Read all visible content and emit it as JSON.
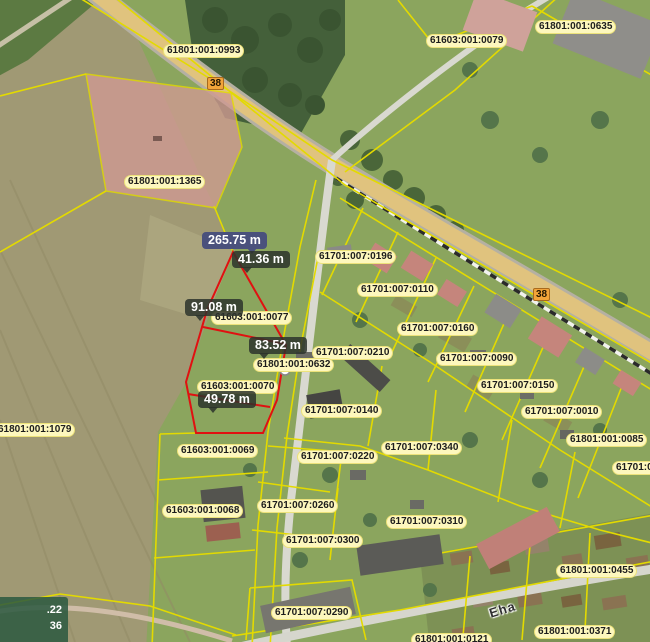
{
  "app": {
    "type": "cadastral-map-viewer"
  },
  "colors": {
    "parcel-line": "#e3da00",
    "measure-line": "#e01111",
    "label-bg": "#fdf7bd",
    "label-border": "#ece27a",
    "label-text": "#1c1c1c",
    "road-badge-bg": "#f2a43a",
    "road-badge-border": "#a86a1e",
    "measure-seg-bg": "rgba(44,51,44,0.85)",
    "measure-total-bg": "#4a517c",
    "measure-text": "#ffffff",
    "coords-bg": "rgba(42,88,64,0.85)",
    "coords-text": "#ffffff"
  },
  "cadastral_labels": [
    {
      "text": "61801:001:0993",
      "x": 163,
      "y": 44
    },
    {
      "text": "61603:001:0079",
      "x": 426,
      "y": 34
    },
    {
      "text": "61801:001:0635",
      "x": 535,
      "y": 20
    },
    {
      "text": "61801:001:1365",
      "x": 124,
      "y": 175
    },
    {
      "text": "61701:007:0196",
      "x": 315,
      "y": 250
    },
    {
      "text": "61701:007:0110",
      "x": 357,
      "y": 283
    },
    {
      "text": "61603:001:0077",
      "x": 211,
      "y": 311
    },
    {
      "text": "61701:007:0160",
      "x": 397,
      "y": 322
    },
    {
      "text": "61701:007:0210",
      "x": 312,
      "y": 346
    },
    {
      "text": "61701:007:0090",
      "x": 436,
      "y": 352
    },
    {
      "text": "61801:001:0632",
      "x": 253,
      "y": 358
    },
    {
      "text": "61701:007:0150",
      "x": 477,
      "y": 379
    },
    {
      "text": "61603:001:0070",
      "x": 197,
      "y": 380
    },
    {
      "text": "61701:007:0140",
      "x": 301,
      "y": 404
    },
    {
      "text": "61701:007:0010",
      "x": 521,
      "y": 405
    },
    {
      "text": "61801:001:1079",
      "x": -6,
      "y": 423
    },
    {
      "text": "61801:001:0085",
      "x": 566,
      "y": 433
    },
    {
      "text": "61701:007:0340",
      "x": 381,
      "y": 441
    },
    {
      "text": "61603:001:0069",
      "x": 177,
      "y": 444
    },
    {
      "text": "61701:007:0220",
      "x": 297,
      "y": 450
    },
    {
      "text": "61701:00",
      "x": 612,
      "y": 461
    },
    {
      "text": "61701:007:0260",
      "x": 257,
      "y": 499
    },
    {
      "text": "61603:001:0068",
      "x": 162,
      "y": 504
    },
    {
      "text": "61701:007:0310",
      "x": 386,
      "y": 515
    },
    {
      "text": "61701:007:0300",
      "x": 282,
      "y": 534
    },
    {
      "text": "61801:001:0455",
      "x": 556,
      "y": 564
    },
    {
      "text": "61701:007:0290",
      "x": 271,
      "y": 606
    },
    {
      "text": "61801:001:0371",
      "x": 534,
      "y": 625
    },
    {
      "text": "61801:001:0121",
      "x": 411,
      "y": 633
    }
  ],
  "measure_labels": [
    {
      "text": "265.75 m",
      "x": 202,
      "y": 232,
      "style": "total"
    },
    {
      "text": "41.36 m",
      "x": 232,
      "y": 251,
      "style": "segment"
    },
    {
      "text": "91.08 m",
      "x": 185,
      "y": 299,
      "style": "segment"
    },
    {
      "text": "83.52 m",
      "x": 249,
      "y": 337,
      "style": "segment"
    },
    {
      "text": "49.78 m",
      "x": 198,
      "y": 391,
      "style": "segment"
    }
  ],
  "road_badges": [
    {
      "text": "38",
      "x": 207,
      "y": 77
    },
    {
      "text": "38",
      "x": 533,
      "y": 288
    }
  ],
  "street_labels": [
    {
      "text": "Eha",
      "x": 489,
      "y": 602,
      "rotation": -17
    }
  ],
  "coords_readout": {
    "line1": ".22",
    "line2": "36"
  }
}
